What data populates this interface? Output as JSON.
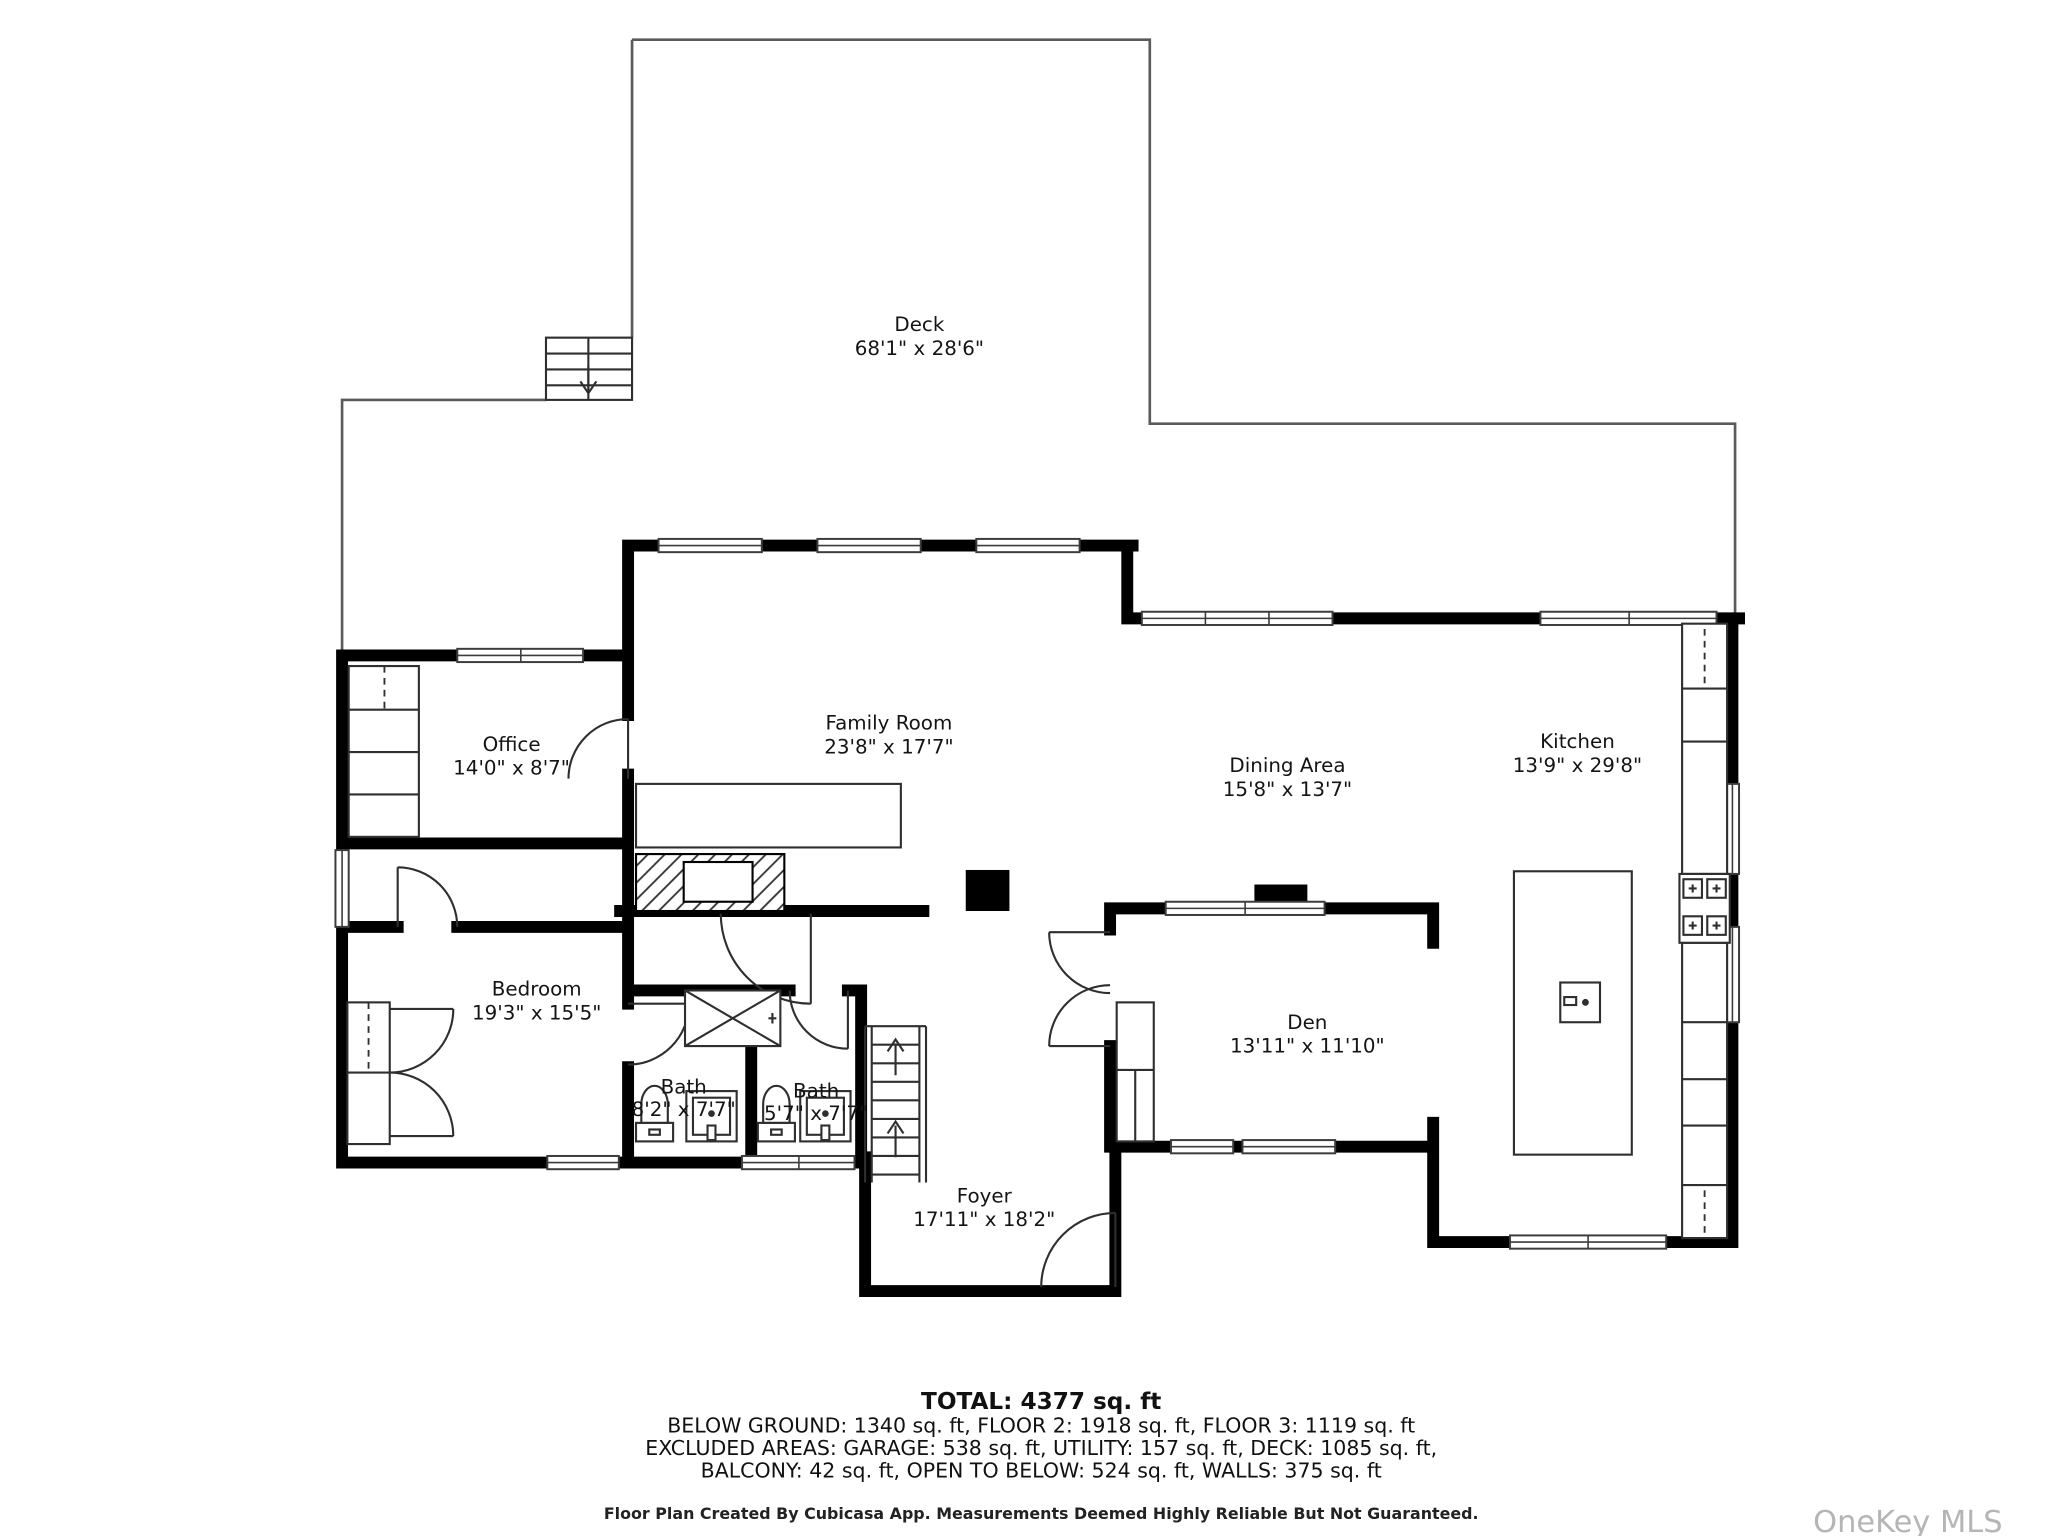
{
  "rooms": [
    {
      "name": "Deck",
      "dims": "68'1\" x 28'6\""
    },
    {
      "name": "Office",
      "dims": "14'0\" x 8'7\""
    },
    {
      "name": "Family Room",
      "dims": "23'8\" x 17'7\""
    },
    {
      "name": "Dining Area",
      "dims": "15'8\" x 13'7\""
    },
    {
      "name": "Kitchen",
      "dims": "13'9\" x 29'8\""
    },
    {
      "name": "Bedroom",
      "dims": "19'3\" x 15'5\""
    },
    {
      "name": "Bath",
      "dims": "8'2\" x 7'7\""
    },
    {
      "name": "Bath",
      "dims": "5'7\" x 7'7\""
    },
    {
      "name": "Den",
      "dims": "13'11\" x 11'10\""
    },
    {
      "name": "Foyer",
      "dims": "17'11\" x 18'2\""
    }
  ],
  "summary": {
    "total": "TOTAL: 4377 sq. ft",
    "line1": "BELOW GROUND: 1340 sq. ft, FLOOR 2: 1918 sq. ft, FLOOR 3: 1119 sq. ft",
    "line2": "EXCLUDED AREAS: GARAGE: 538 sq. ft, UTILITY: 157 sq. ft, DECK: 1085 sq. ft,",
    "line3": "BALCONY: 42 sq. ft, OPEN TO BELOW: 524 sq. ft, WALLS: 375 sq. ft"
  },
  "footer": "Floor Plan Created By Cubicasa App. Measurements Deemed Highly Reliable But Not Guaranteed.",
  "watermark": "OneKey MLS",
  "colors": {
    "wall": "#000000",
    "thin_line": "#2f2f2f",
    "deck_line": "#5a5a5a",
    "text": "#141414",
    "watermark": "#b5b5b5",
    "background": "#ffffff"
  }
}
